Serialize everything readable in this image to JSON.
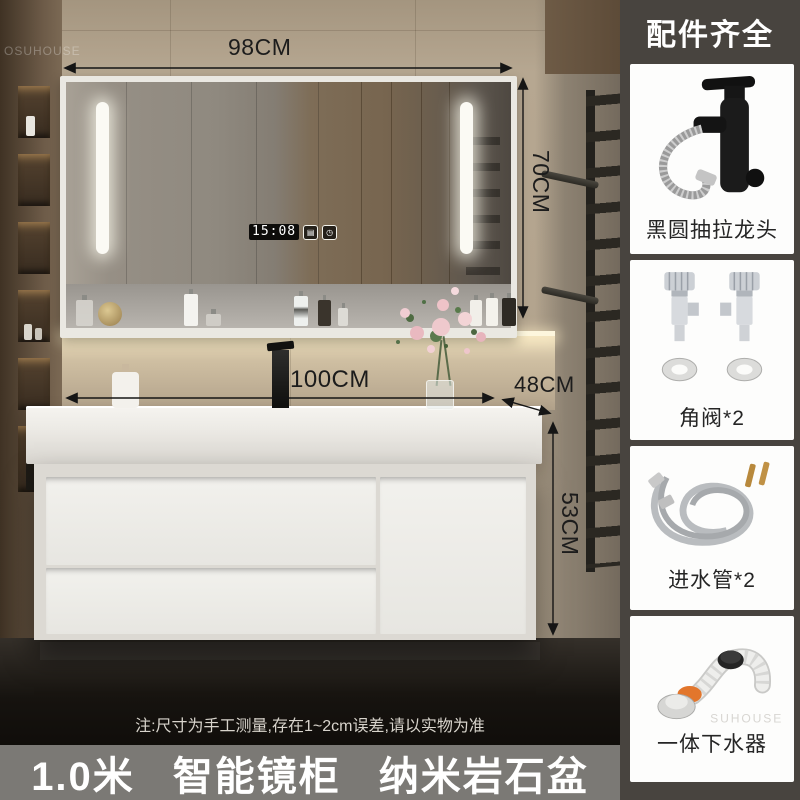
{
  "banner": {
    "part1": "1.0米",
    "part2": "智能镜柜",
    "part3": "纳米岩石盆"
  },
  "note": "注:尺寸为手工测量,存在1~2cm误差,请以实物为准",
  "dimensions": {
    "mirror_width": "98CM",
    "mirror_height": "70CM",
    "counter_width": "100CM",
    "counter_depth": "48CM",
    "cabinet_height": "53CM"
  },
  "mirror": {
    "time": "15:08",
    "defog_glyph": "▤",
    "timer_glyph": "◷"
  },
  "sidebar": {
    "header": "配件齐全",
    "items": [
      {
        "label": "黑圆抽拉龙头"
      },
      {
        "label": "角阀*2"
      },
      {
        "label": "进水管*2"
      },
      {
        "label": "一体下水器"
      }
    ]
  },
  "watermark": {
    "photo": "OSUHOUSE",
    "drain": "SUHOUSE"
  },
  "colors": {
    "sidebar_bg": "#48443f",
    "banner_bg": "#7b7975",
    "dim_text": "#1c1c1c",
    "accent_warm_glow": "#fdf6dd"
  }
}
